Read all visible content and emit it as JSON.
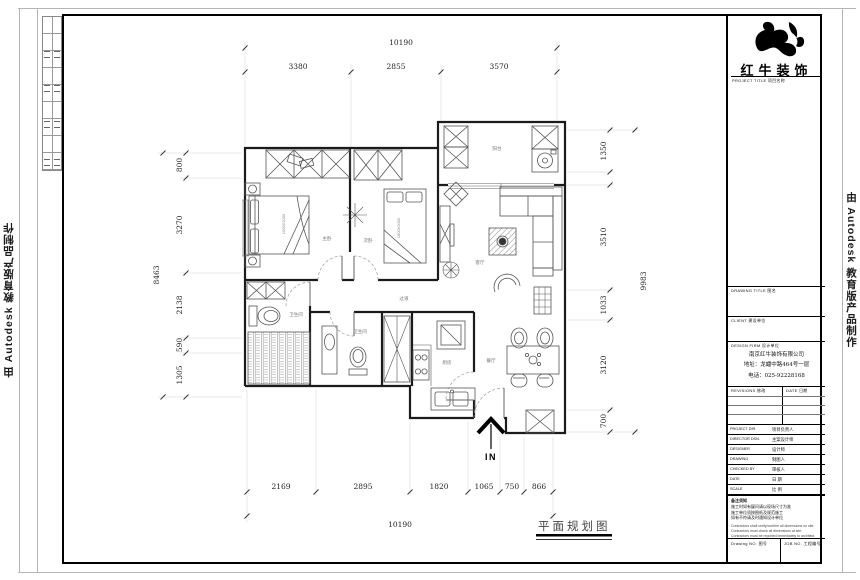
{
  "watermarks": {
    "left": "由 Autodesk 教育版产品制作",
    "right": "由 Autodesk 教育版产品制作"
  },
  "title_block": {
    "logo_name": "红牛装饰",
    "project_title_label": "PROJECT TITLE  项目名称",
    "drawing_title_label": "DRAWING TITLE  图名",
    "client_label": "CLIENT  建设单位",
    "design_firm_label": "DESIGN FIRM  设计单位",
    "firm_lines": [
      "南京红牛装饰有限公司",
      "地址：龙蟠中路464号一层",
      "电话：025-92228168"
    ],
    "revisions_label": "REVISIONS  修改",
    "date_col_label": "DATE  日期",
    "rows": [
      {
        "en": "PROJECT DIR.",
        "cn": "项目负责人"
      },
      {
        "en": "DIRECTOR DSN.",
        "cn": "主案设计师"
      },
      {
        "en": "DESIGNER",
        "cn": "设计师"
      },
      {
        "en": "DRAWING",
        "cn": "制图人"
      },
      {
        "en": "CHECKED BY",
        "cn": "审核人"
      },
      {
        "en": "DATE",
        "cn": "日  期"
      },
      {
        "en": "SCALE",
        "cn": "比  例"
      }
    ],
    "notes_title": "备注须知",
    "notes_cn": [
      "施工时如有疑问请以现场尺寸为准",
      "施工单位须按图纸及规范施工",
      "如有不符请及时通知设计单位"
    ],
    "notes_en": [
      "Contractors shall verify/confirm all dimensions on site.",
      "Contractors must check all dimensions at site.",
      "Contractors must be reported immediately to architect."
    ],
    "drawing_no_label": "Drawing NO.  图号",
    "job_no_label": "JOB NO.  工程编号"
  },
  "plan": {
    "title": "平面规划图",
    "entry_label": "IN",
    "rooms": {
      "master": "主卧",
      "second": "次卧",
      "living": "客厅",
      "dining": "餐厅",
      "kitchen": "厨房",
      "bath1": "卫生间",
      "bath2": "卫生间",
      "balcony": "阳台",
      "hall": "过道"
    },
    "bed_master": "1500X2000",
    "bed_second": "1800X2000",
    "dims": {
      "top_overall": "10190",
      "top": [
        "3380",
        "2855",
        "3570"
      ],
      "bottom": [
        "2169",
        "2895",
        "1820",
        "1065",
        "750",
        "866"
      ],
      "bottom_overall": "10190",
      "left_overall": "8463",
      "left": [
        "800",
        "3270",
        "2138",
        "590",
        "1305"
      ],
      "right_overall": "9983",
      "right": [
        "1350",
        "3510",
        "1033",
        "3120",
        "700"
      ]
    }
  }
}
